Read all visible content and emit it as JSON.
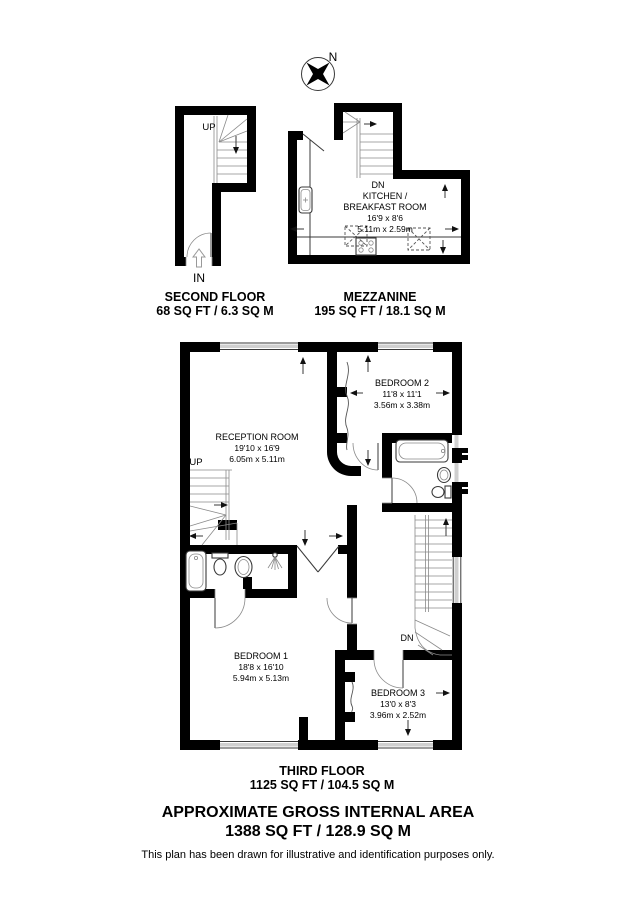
{
  "document": {
    "footer_title": "APPROXIMATE GROSS INTERNAL AREA",
    "footer_area": "1388 SQ FT / 128.9 SQ M",
    "disclaimer": "This plan has been drawn for illustrative and identification purposes only."
  },
  "colors": {
    "wall": "#000000",
    "window": "#cfcfcf",
    "line": "#3a3a3a"
  },
  "compass": {
    "north_label": "N"
  },
  "floors": [
    {
      "name": "SECOND FLOOR",
      "area": "68 SQ FT / 6.3 SQ M",
      "stairs_label": "UP",
      "entrance_label": "IN"
    },
    {
      "name": "MEZZANINE",
      "area": "195 SQ FT / 18.1 SQ M",
      "stairs_label": "DN",
      "room": {
        "name_line1": "KITCHEN /",
        "name_line2": "BREAKFAST ROOM",
        "dims_imperial": "16'9 x 8'6",
        "dims_metric": "5.11m x 2.59m"
      }
    },
    {
      "name": "THIRD FLOOR",
      "area": "1125 SQ FT / 104.5 SQ M",
      "stairs_up_label": "UP",
      "stairs_down_label": "DN",
      "rooms": [
        {
          "name": "RECEPTION ROOM",
          "dims_imperial": "19'10 x 16'9",
          "dims_metric": "6.05m x 5.11m"
        },
        {
          "name": "BEDROOM 2",
          "dims_imperial": "11'8 x 11'1",
          "dims_metric": "3.56m x 3.38m"
        },
        {
          "name": "BEDROOM 1",
          "dims_imperial": "18'8 x 16'10",
          "dims_metric": "5.94m x 5.13m"
        },
        {
          "name": "BEDROOM 3",
          "dims_imperial": "13'0 x 8'3",
          "dims_metric": "3.96m x 2.52m"
        }
      ]
    }
  ]
}
